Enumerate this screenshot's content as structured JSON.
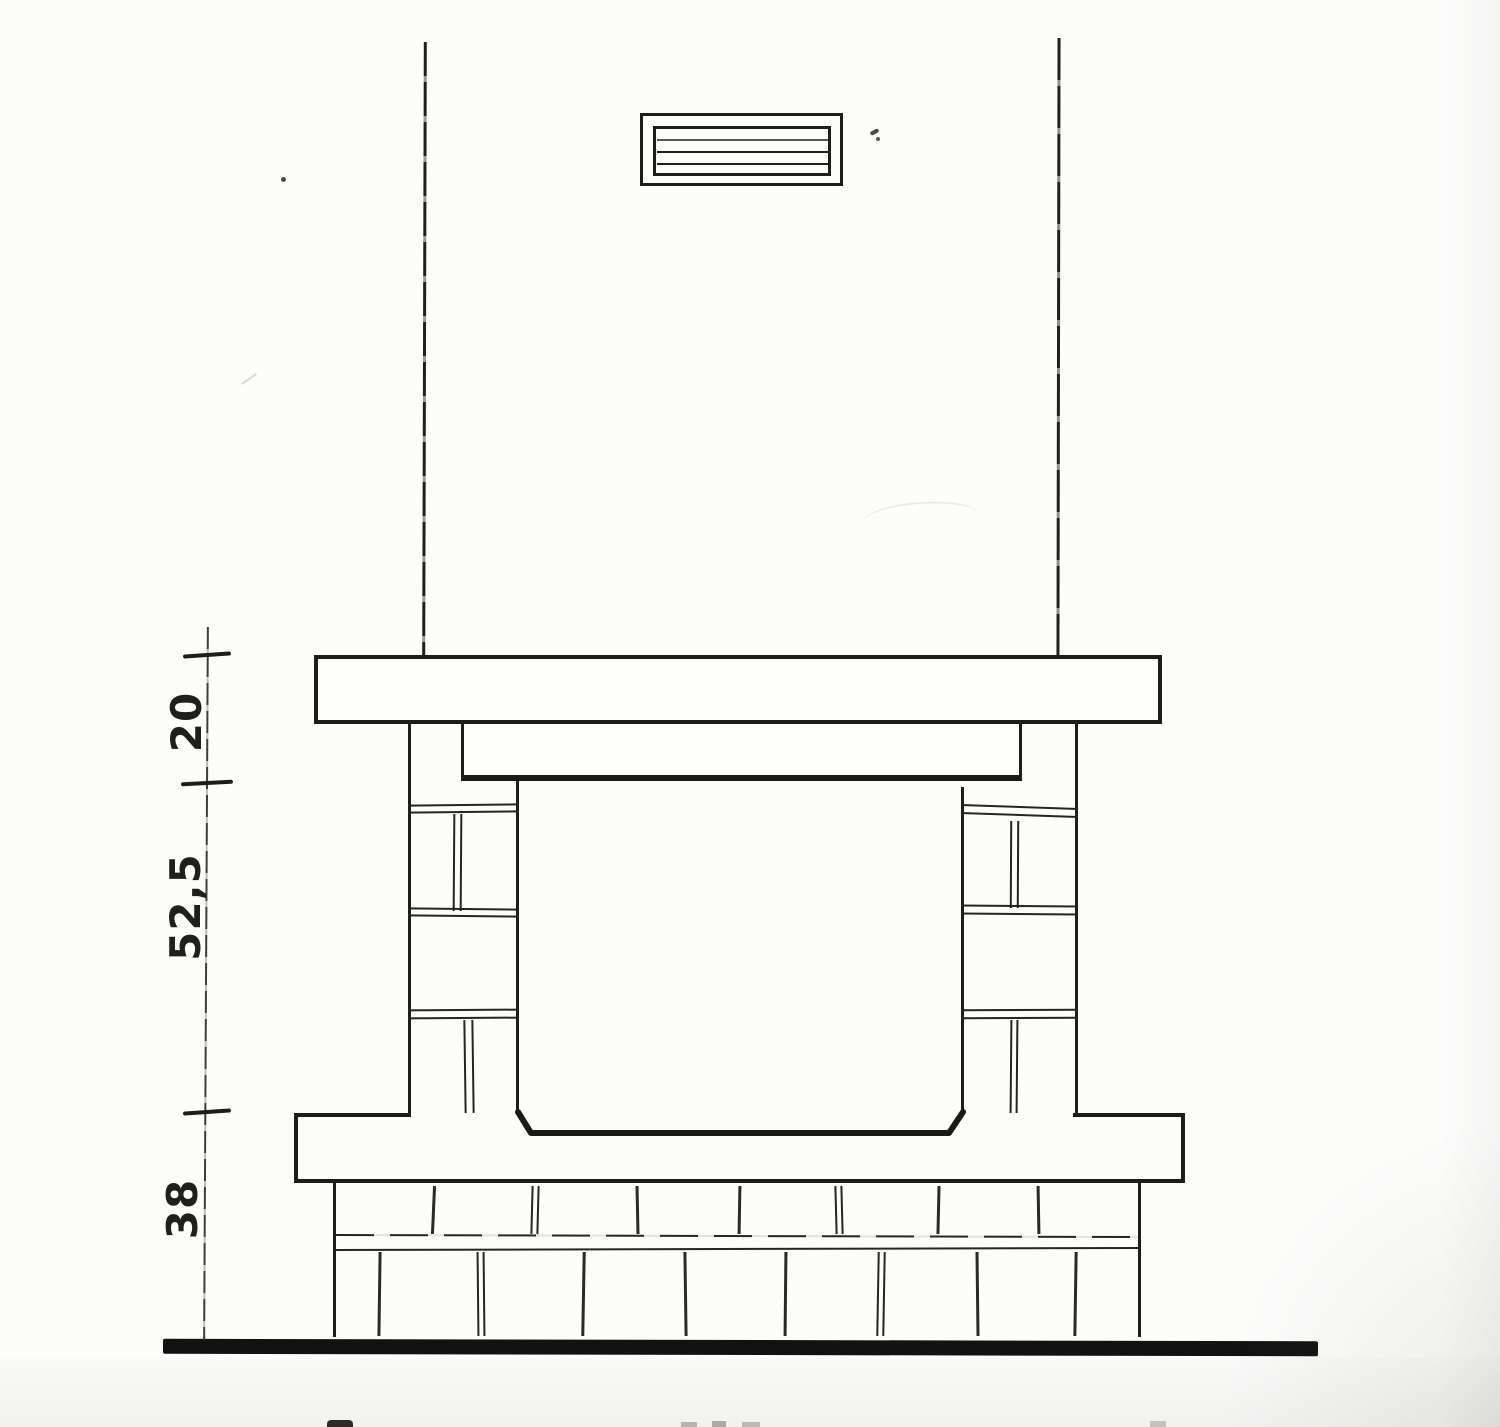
{
  "dimension_labels": {
    "top_segment": "20",
    "middle_segment": "52,5",
    "bottom_segment": "38"
  },
  "vent_grille": {
    "louver_count": 3
  },
  "colors": {
    "ink": "#1d1d1b",
    "paper": "#fcfcfb",
    "ground_line": "#121212"
  }
}
